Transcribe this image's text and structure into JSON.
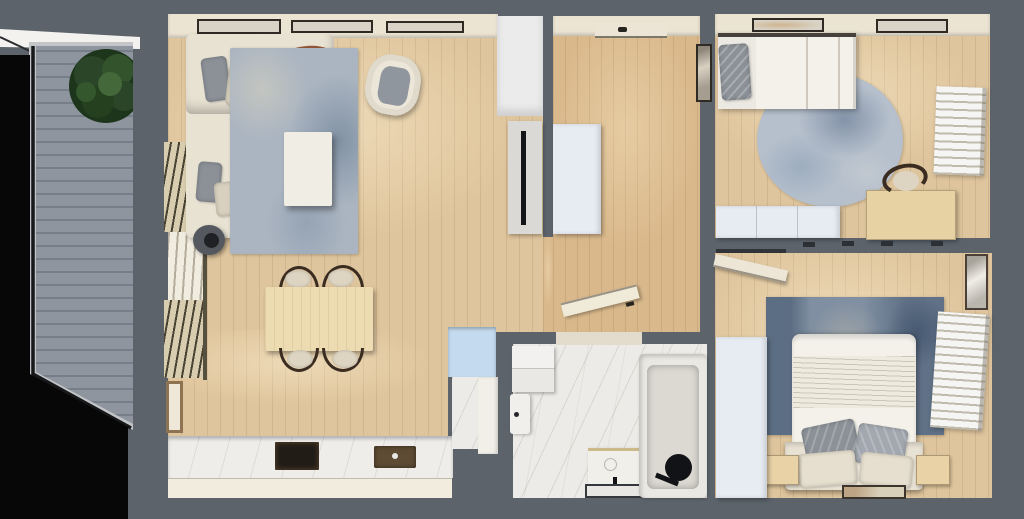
{
  "scene": {
    "title": "apartment-floor-plan-3d-top-down-render",
    "view": "top-down",
    "style": "photorealistic architectural render on slate background",
    "visible_text": "none"
  },
  "palette": {
    "bg": "#5c636b",
    "void": "#070708",
    "roof-edge": "#f3f2ef",
    "deck": "#8e959e",
    "deck-frame": "#c3c5c8",
    "railing": "#17181a",
    "plant-dark": "#1d351b",
    "plant-mid": "#2a4527",
    "plant-light": "#44683a",
    "wood": "#dfc59d",
    "wood-warm": "#d9b88b",
    "wall-cream": "#ebe4d3",
    "frame-dark": "#2f2a24",
    "frame-fill": "#d8d3c6",
    "sofa": "#e8e2d3",
    "pillow-gray": "#8b9197",
    "pillow-cream": "#d9d1bf",
    "throw-rust": "#96573a",
    "throw-dark": "#72412a",
    "rug1": "#abb5c1",
    "rug1-dark": "#8092a6",
    "rug1-light": "#c9c9c0",
    "coffee-table": "#f0ede4",
    "armchair": "#ece6d9",
    "armchair-cushion": "#8f969e",
    "pouf": "#55595f",
    "kettle": "#1f2124",
    "dining-table": "#eddcb2",
    "chair-frame": "#3a2c20",
    "chair-seat": "#ddd4c1",
    "counter-marble": "#efede9",
    "cooktop": "#221c17",
    "sink": "#5d4b33",
    "faucet": "#e8e8e6",
    "cabinet-cream": "#f2ecdf",
    "cabinet-white": "#ebebec",
    "cabinet-blue": "#c4daee",
    "blind-louver": "#d9cdaf",
    "blind-gap": "#857a5f",
    "wardrobe-white": "#e7ebf2",
    "tv-panel": "#dbd9d5",
    "tv-screen": "#141518",
    "door-leaf": "#ece5d5",
    "door-handle": "#26241f",
    "bed-white": "#f4f1ea",
    "bed-frame-line": "#46413a",
    "rug-round": "#b6c0cc",
    "rug-round-dark": "#8da0b6",
    "desk": "#e6d2a2",
    "radiator-white": "#f5f5f3",
    "rug2": "#8c9aab",
    "rug2-dark": "#5a6d84",
    "rug2-light": "#c9c4b6",
    "duvet": "#f3f1ea",
    "headboard": "#e8e2d4",
    "nightstand": "#e8d2a6",
    "art-frame-wood": "#8d7352",
    "art-fill": "#d8d1c2",
    "bath-marble": "#edebe7",
    "tub": "#eae8e2",
    "tub-inner": "#dcd9d2",
    "fixture-black": "#121316",
    "washer": "#f2f1ef",
    "mat-frame": "#35383c"
  },
  "rooms": [
    {
      "id": "balcony",
      "label": "balcony",
      "items": [
        "gray plank deck",
        "black railing",
        "potted plant"
      ]
    },
    {
      "id": "living-room",
      "label": "living room / kitchen",
      "items": [
        "L-shaped cream sofa",
        "gray and cream pillows",
        "rust throw blanket",
        "blue-gray rug",
        "white coffee table",
        "cream armchair",
        "dark pouf side table",
        "window blinds",
        "dining table with four chairs",
        "kitchen counter with cooktop and sink",
        "tall white cabinet",
        "TV panel",
        "blue cabinet"
      ]
    },
    {
      "id": "hallway",
      "label": "entry hallway",
      "items": [
        "entry door",
        "white wardrobe",
        "wall art",
        "open bathroom door"
      ]
    },
    {
      "id": "bedroom-1",
      "label": "top bedroom",
      "items": [
        "single bed",
        "gray pillow",
        "round blue rug",
        "wooden desk",
        "desk chair",
        "white radiator blind",
        "low wardrobe",
        "two windows"
      ]
    },
    {
      "id": "bedroom-2",
      "label": "bottom bedroom",
      "items": [
        "double bed",
        "gray and cream pillows",
        "distressed blue rug",
        "two wooden nightstands",
        "white radiator blind",
        "wall art",
        "tall wardrobe",
        "floor artwork",
        "open door"
      ]
    },
    {
      "id": "bathroom",
      "label": "bathroom",
      "items": [
        "marble floor",
        "washer column",
        "toilet",
        "vanity with basin",
        "dark-rimmed floor mat",
        "bathtub",
        "black shower fixture"
      ]
    }
  ]
}
